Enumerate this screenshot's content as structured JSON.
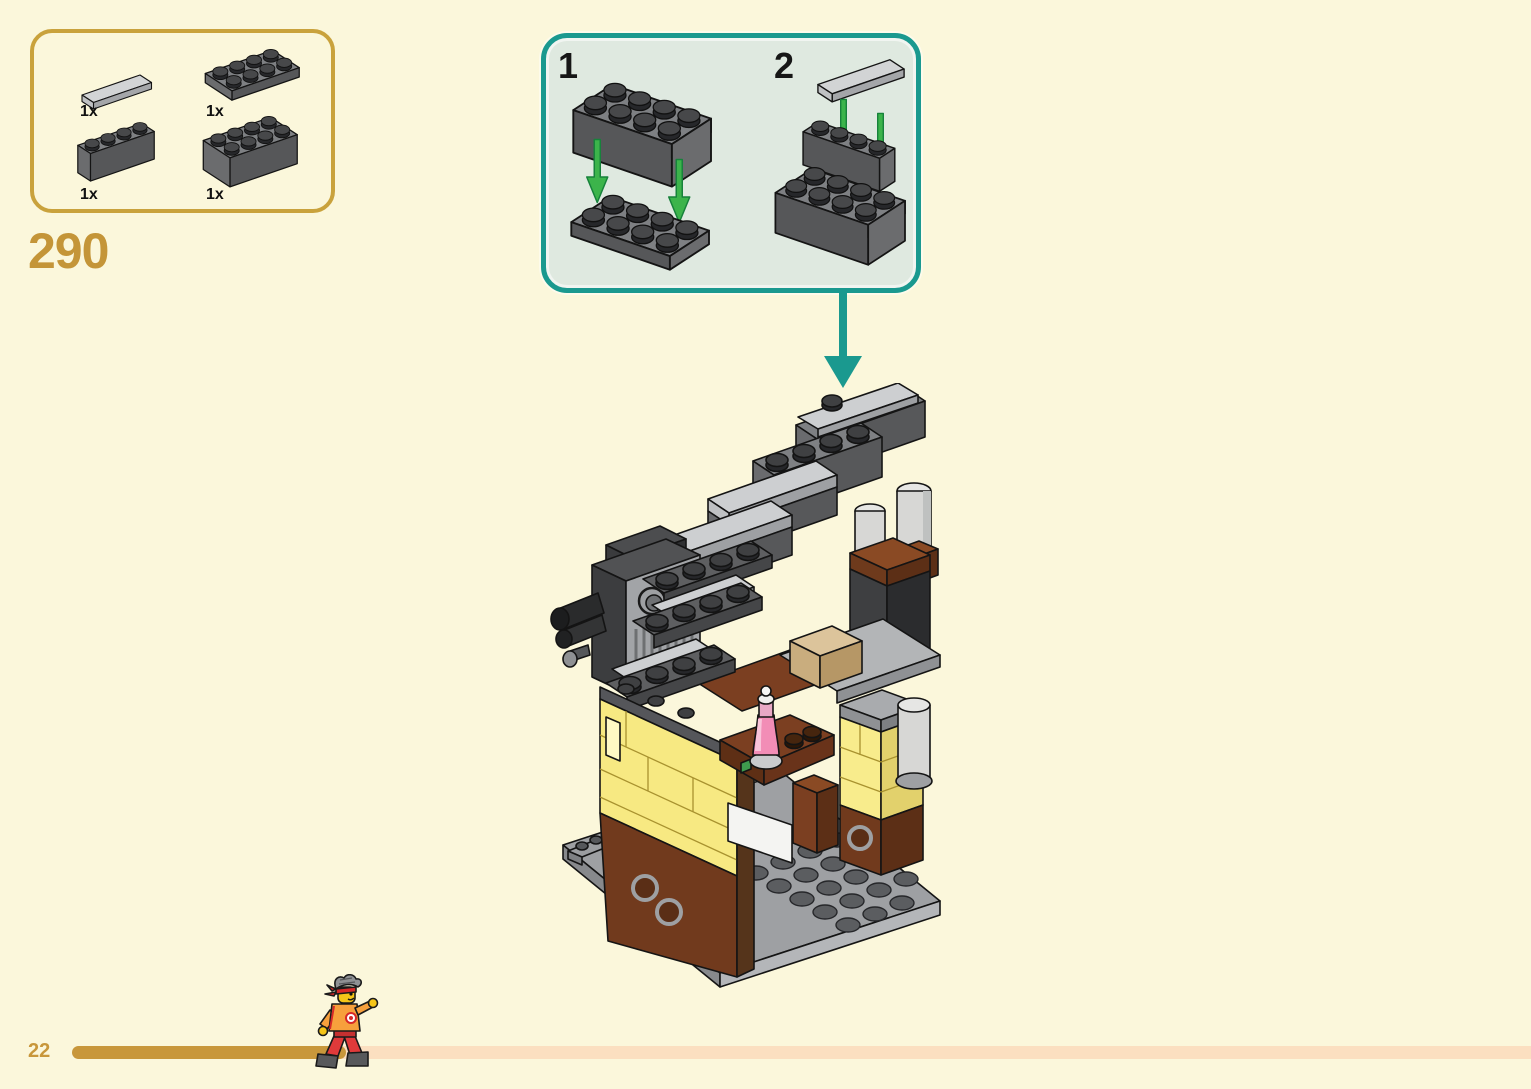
{
  "page": {
    "background_color": "#FBF7DB",
    "step_number": "290",
    "page_number": "22"
  },
  "parts_panel": {
    "border_color": "#C9A23C",
    "parts": [
      {
        "qty": "1x",
        "part_icon": "tile-1x4-light-gray"
      },
      {
        "qty": "1x",
        "part_icon": "plate-2x4-dark-gray"
      },
      {
        "qty": "1x",
        "part_icon": "brick-1x4-dark-gray"
      },
      {
        "qty": "1x",
        "part_icon": "brick-2x4-dark-gray"
      }
    ]
  },
  "callout": {
    "border_color": "#1A998F",
    "background_color": "#DFE9E0",
    "arrow_color": "#3CB44B",
    "substeps": [
      {
        "label": "1",
        "icon": "place-brick-2x4-onto-plate-2x4"
      },
      {
        "label": "2",
        "icon": "place-tile-1x4-onto-stepped-bricks"
      }
    ]
  },
  "model": {
    "icon": "lego-staircase-building-model",
    "colors": {
      "wall_yellow": "#F7E982",
      "wood_brown": "#713A1D",
      "stairs_gray": "#7E8083",
      "bottle_pink": "#F28DB6",
      "baseplate_gray": "#9EA0A3"
    }
  },
  "footer": {
    "progress_color": "#C8973B",
    "track_color": "#FBDFC0",
    "mascot_icon": "running-minifigure"
  }
}
